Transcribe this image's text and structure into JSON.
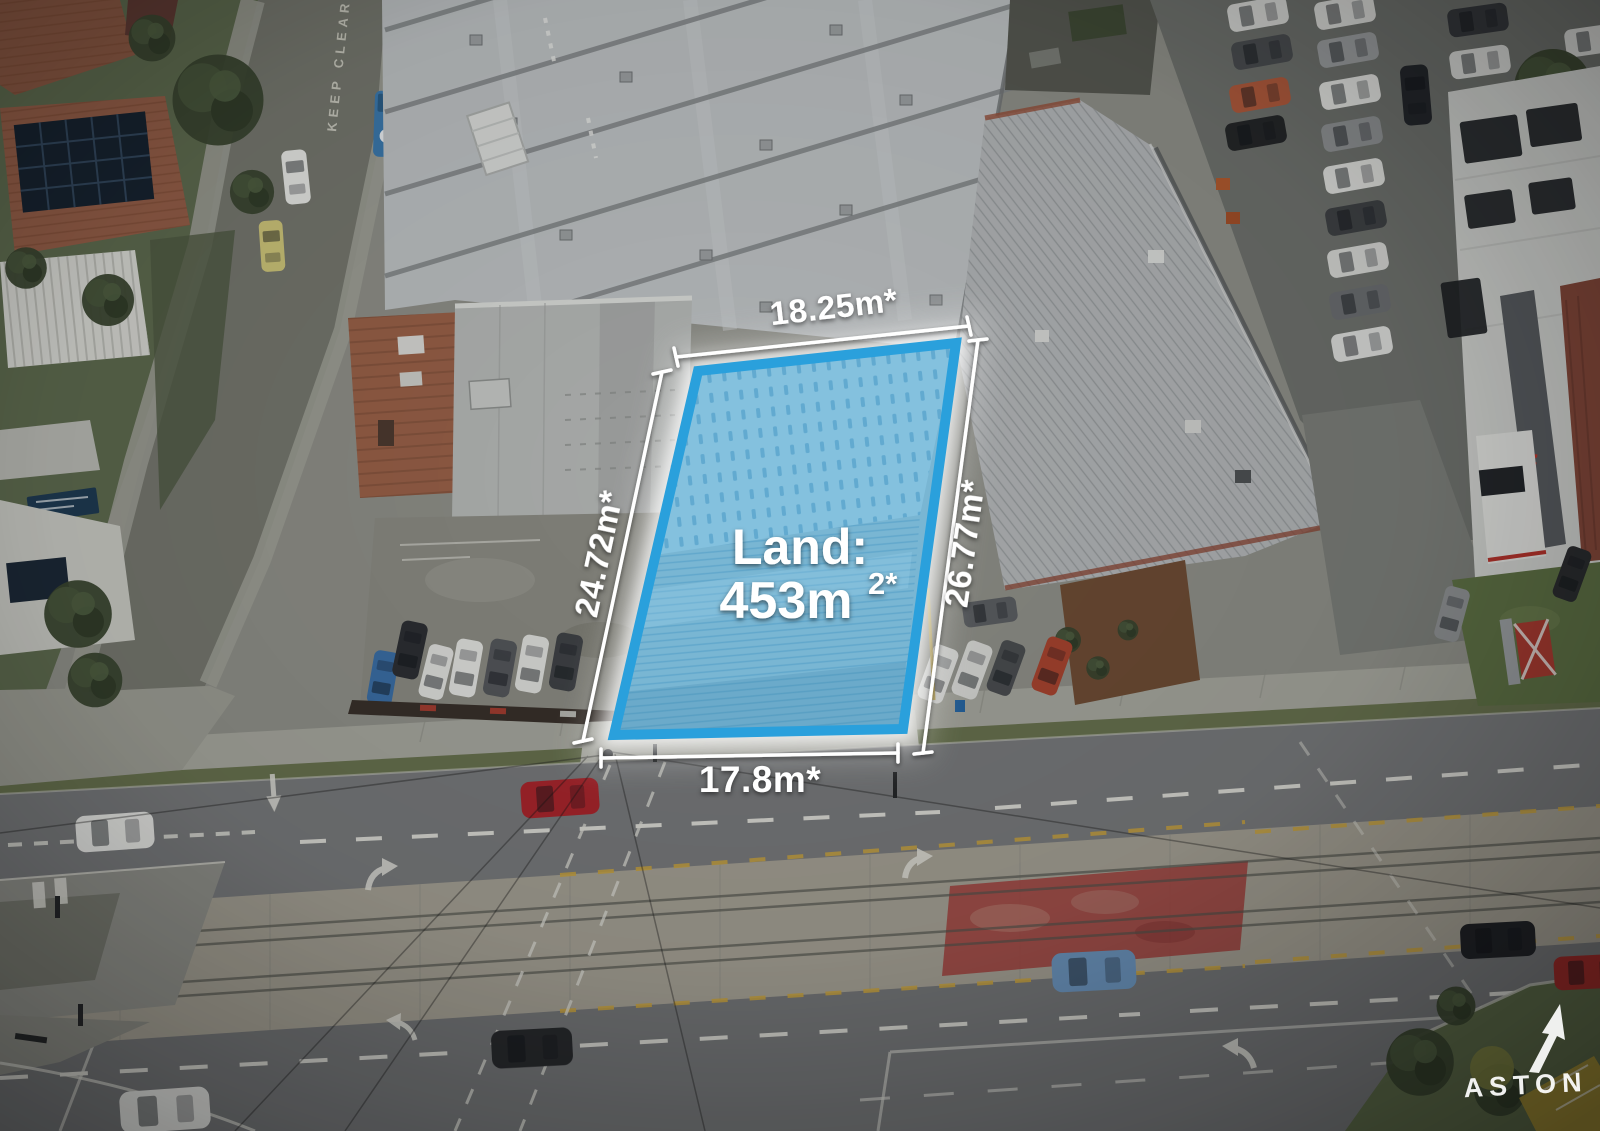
{
  "overlay": {
    "land_label": "Land:",
    "land_area_value": "453m",
    "land_area_superscript": "2*",
    "dimensions": {
      "top": "18.25m*",
      "right": "26.77m*",
      "left": "24.72m*",
      "bottom": "17.8m*"
    },
    "boundary_color": "#2aa0dc",
    "dimension_line_color": "#ffffff"
  },
  "road_markings": {
    "keep_clear": "KEEP CLEAR"
  },
  "signage": {
    "nissan": "NISSAN"
  },
  "branding": {
    "agency": "ASTON"
  }
}
